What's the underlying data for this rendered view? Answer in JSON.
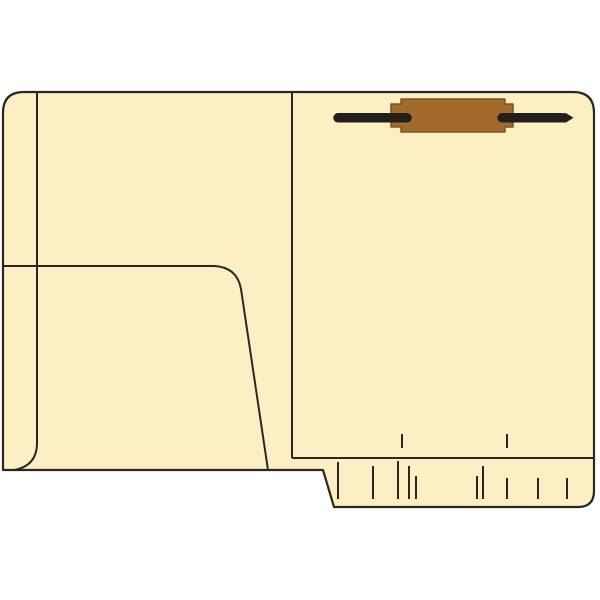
{
  "product": {
    "name": "manila-fastener-folder-with-inside-pocket",
    "view": "open-folder-product-illustration"
  },
  "colors": {
    "background": "#ffffff",
    "folder_fill": "#FBEFC3",
    "outline": "#2B2823",
    "fastener_base": "#A16C2B",
    "fastener_base_edge": "#7F551F",
    "prong": "#231F1C"
  },
  "folder": {
    "parts": {
      "left_panel": "front cover inside with diagonal pocket",
      "right_panel": "back cover inside with two-prong fastener at top",
      "bottom_strip": "reinforced end-tab strip with printed position marks"
    },
    "bottom_strip": {
      "ticks_above": [
        {
          "x": 402,
          "y1": 434,
          "y2": 448
        },
        {
          "x": 507,
          "y1": 434,
          "y2": 448
        }
      ],
      "ticks_below": [
        {
          "x": 338,
          "y1": 462,
          "y2": 499
        },
        {
          "x": 373,
          "y1": 466,
          "y2": 499
        },
        {
          "x": 398,
          "y1": 461,
          "y2": 499
        },
        {
          "x": 409,
          "y1": 466,
          "y2": 499
        },
        {
          "x": 416,
          "y1": 476,
          "y2": 499
        },
        {
          "x": 477,
          "y1": 476,
          "y2": 499
        },
        {
          "x": 483,
          "y1": 466,
          "y2": 499
        },
        {
          "x": 507,
          "y1": 478,
          "y2": 499
        },
        {
          "x": 538,
          "y1": 478,
          "y2": 499
        },
        {
          "x": 567,
          "y1": 478,
          "y2": 499
        }
      ]
    }
  }
}
